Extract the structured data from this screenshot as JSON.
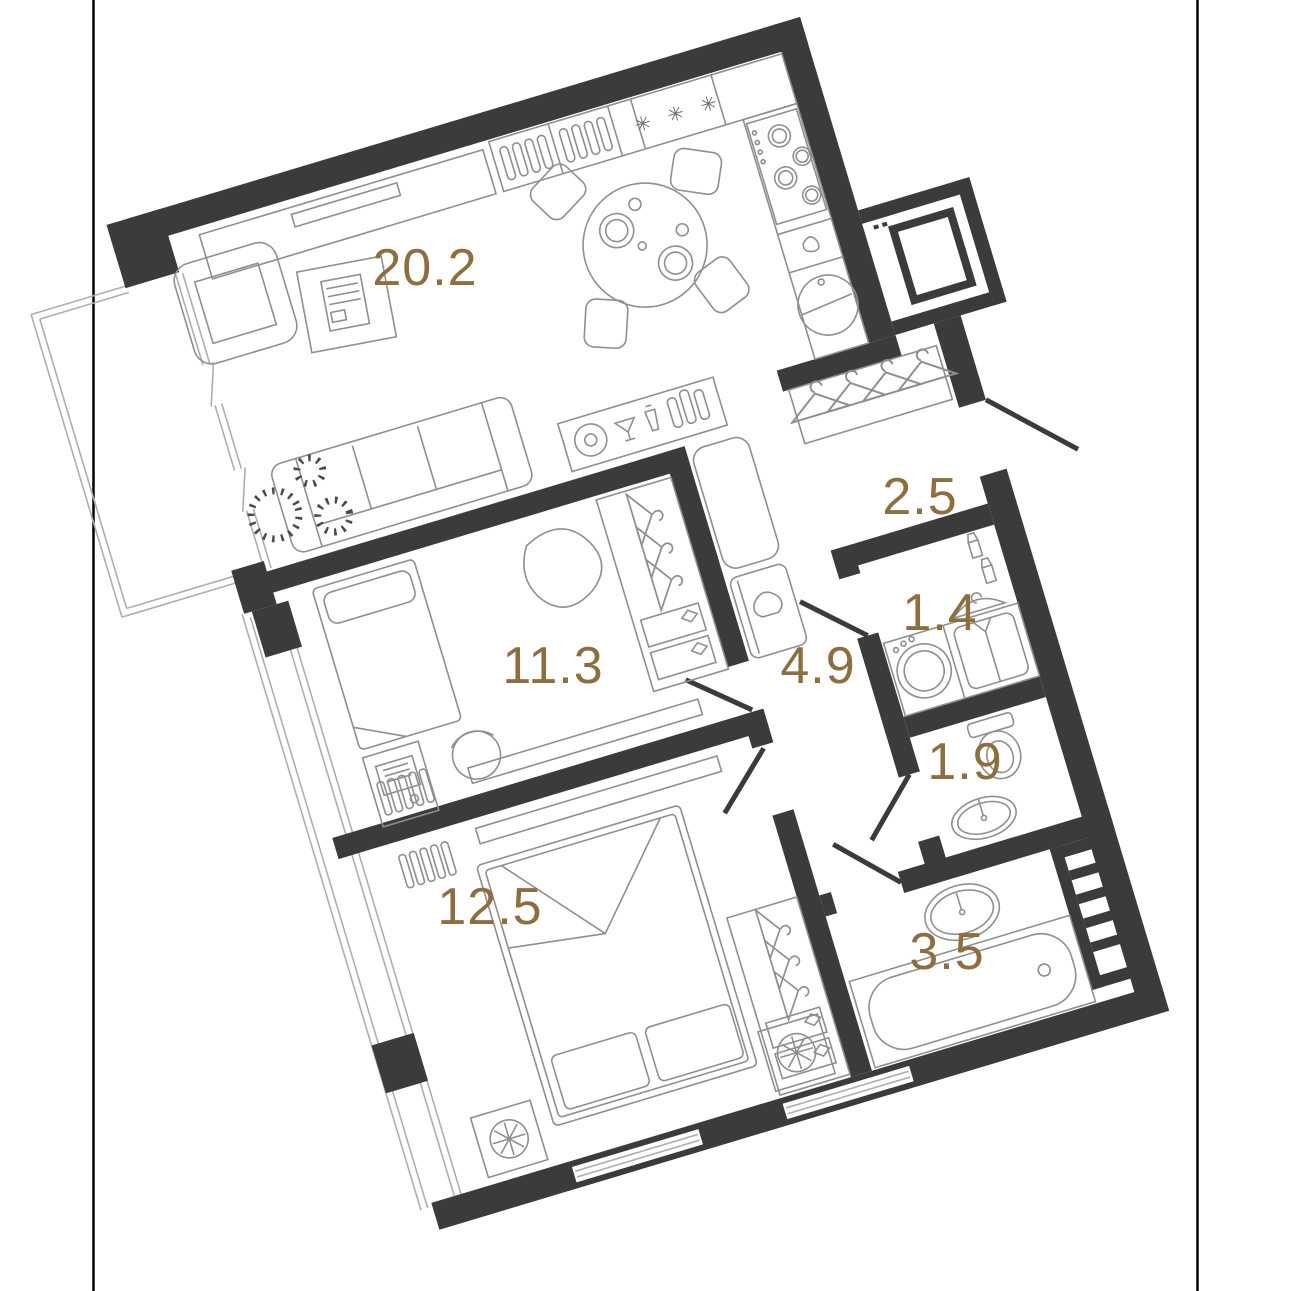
{
  "page": {
    "background": "#ffffff",
    "kind": "apartment floor plan drawing"
  },
  "frame": {
    "color": "#000000",
    "note": "two thin vertical page-edge lines"
  },
  "floor_plan": {
    "rotation_deg": -16.7,
    "colors": {
      "wall": "#3b3b39",
      "furniture_line": "#8f8f8d",
      "glazing_line": "#aeaeac",
      "label": "#8d6e3f",
      "plant": "#4a4a48",
      "frame": "#000000"
    },
    "rooms": [
      {
        "name": "living-kitchen",
        "area": "20.2"
      },
      {
        "name": "entry-hall",
        "area": "2.5"
      },
      {
        "name": "laundry",
        "area": "1.4"
      },
      {
        "name": "corridor",
        "area": "4.9"
      },
      {
        "name": "wc",
        "area": "1.9"
      },
      {
        "name": "bedroom-1",
        "area": "11.3"
      },
      {
        "name": "bedroom-2",
        "area": "12.5"
      },
      {
        "name": "bathroom",
        "area": "3.5"
      }
    ],
    "icons": {
      "freezer": "✳ ✳ ✳"
    }
  }
}
